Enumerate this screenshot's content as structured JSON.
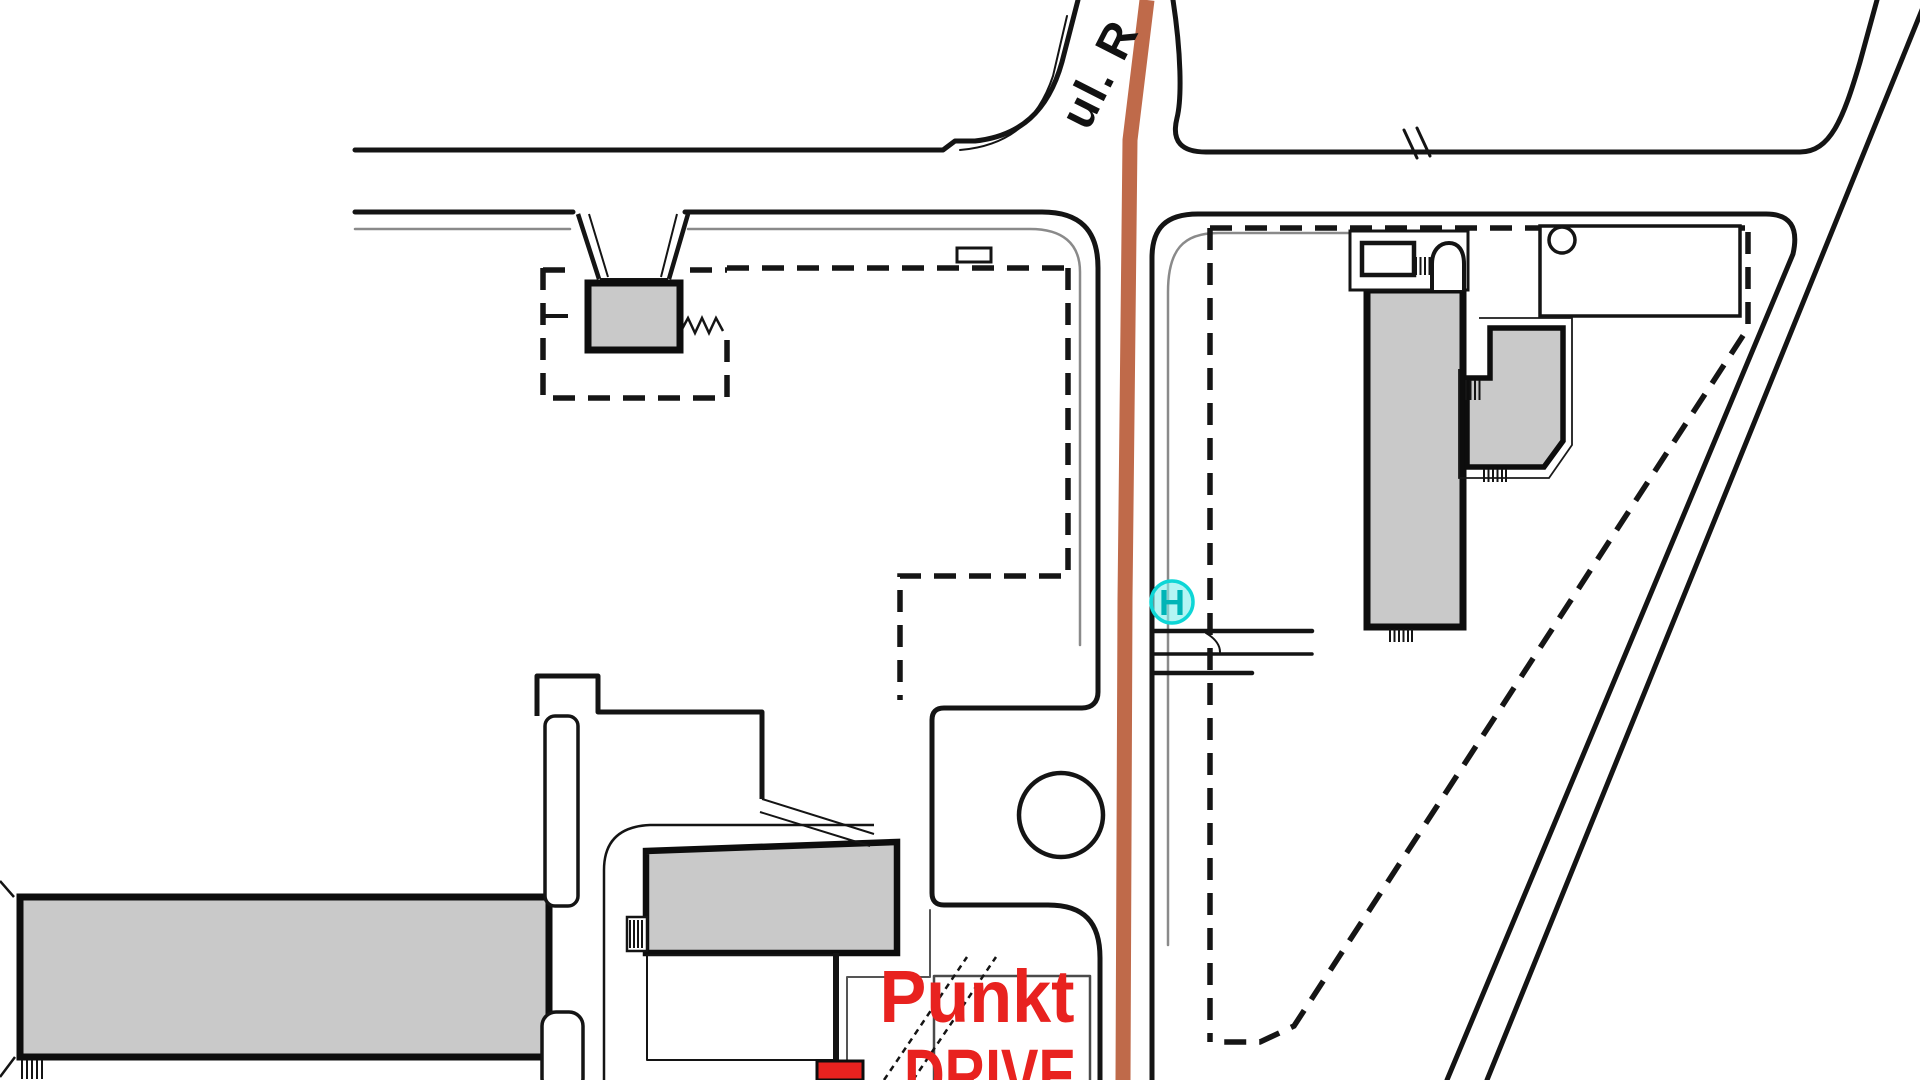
{
  "map": {
    "street_label": "ul. R",
    "poi": {
      "line1": "Punkt",
      "line2": "DRIVE"
    },
    "hydrant_label": "H",
    "colors": {
      "background": "#ffffff",
      "line": "#141414",
      "inner_line": "#8a8a8a",
      "building_fill": "#c9c9c9",
      "building_stroke": "#0d0d0d",
      "road_overlay": "#bf6a4a",
      "poi_red": "#e8221f",
      "hydrant_fill": "#86efee",
      "hydrant_stroke": "#0ed6d6",
      "hydrant_text": "#00b4b6"
    }
  }
}
